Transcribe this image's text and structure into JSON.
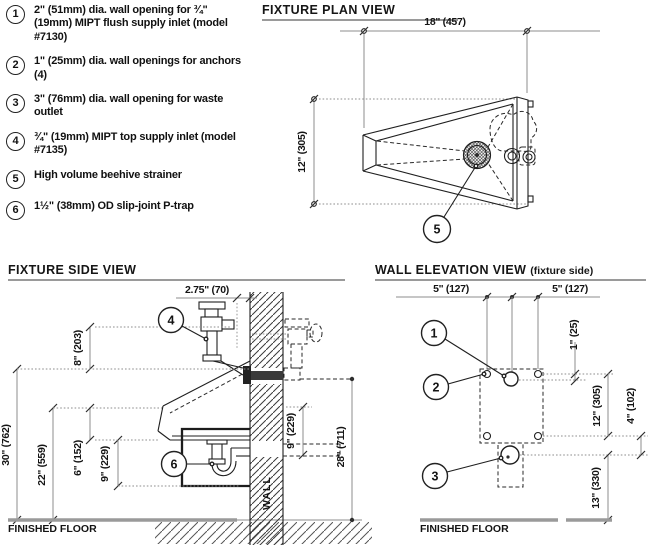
{
  "colors": {
    "ink": "#1f1f1f",
    "dim_line": "#8c8c8c",
    "floor_line": "#9a9a9a"
  },
  "legend": {
    "items": [
      {
        "num": "1",
        "text": "2\" (51mm) dia. wall opening for ¾\" (19mm) MIPT flush supply inlet (model #7130)"
      },
      {
        "num": "2",
        "text": "1\" (25mm) dia. wall openings for anchors (4)"
      },
      {
        "num": "3",
        "text": "3\" (76mm) dia. wall opening for waste outlet"
      },
      {
        "num": "4",
        "text": "¾\" (19mm) MIPT top supply inlet (model #7135)"
      },
      {
        "num": "5",
        "text": "High volume beehive strainer"
      },
      {
        "num": "6",
        "text": "1½\" (38mm) OD slip-joint P-trap"
      }
    ]
  },
  "plan": {
    "title": "FIXTURE PLAN VIEW",
    "dim_width": "18\" (457)",
    "dim_depth": "12\" (305)",
    "callout_strainer": "5"
  },
  "side": {
    "title": "FIXTURE SIDE VIEW",
    "dim_offset": "2.75\" (70)",
    "dim_inlet_above_rim": "8\" (203)",
    "dim_rim_height": "30\" (762)",
    "dim_front_rim": "22\" (559)",
    "dim_basin_depth": "6\" (152)",
    "dim_trap": "9\" (229)",
    "dim_waste": "9\" (229)",
    "dim_flush_height": "28\" (711)",
    "callout_top_inlet": "4",
    "callout_ptrap": "6",
    "wall_label": "WALL",
    "floor_label": "FINISHED FLOOR"
  },
  "elevation": {
    "title": "WALL ELEVATION VIEW",
    "title_suffix": "(fixture side)",
    "dim_left_span": "5\" (127)",
    "dim_right_span": "5\" (127)",
    "dim_flush_offset": "1\" (25)",
    "dim_anchor_span": "12\" (305)",
    "dim_waste_offset": "4\" (102)",
    "dim_waste_height": "13\" (330)",
    "callout_flush": "1",
    "callout_anchor": "2",
    "callout_waste": "3",
    "floor_label": "FINISHED FLOOR"
  }
}
